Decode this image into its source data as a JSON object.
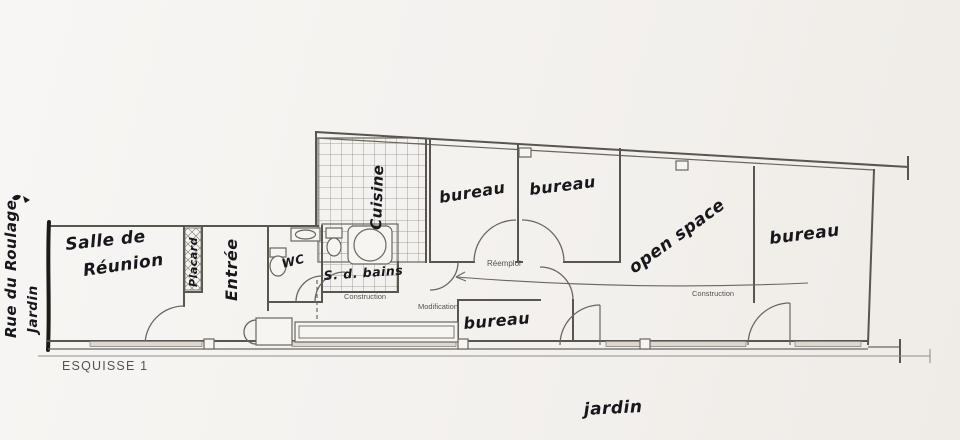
{
  "sheet": {
    "title": "ESQUISSE 1"
  },
  "site": {
    "street_label": "Rue du Roulage",
    "garden_side_label": "Jardin",
    "garden_bottom_label": "jardin"
  },
  "rooms": {
    "meeting_room_line1": "Salle de",
    "meeting_room_line2": "Réunion",
    "closet": "Placard",
    "entrance": "Entrée",
    "wc": "WC",
    "kitchen": "Cuisine",
    "bathroom": "S. d. bains",
    "office": "bureau",
    "open_space": "open space"
  },
  "annotations": {
    "reuse": "Réemploi",
    "construction_center": "Construction",
    "construction_open_space": "Construction",
    "modification": "Modification"
  },
  "colors": {
    "paper": "#f5f3f0",
    "wall": "#5a564f",
    "ink": "#17171c",
    "print": "#55524c"
  }
}
